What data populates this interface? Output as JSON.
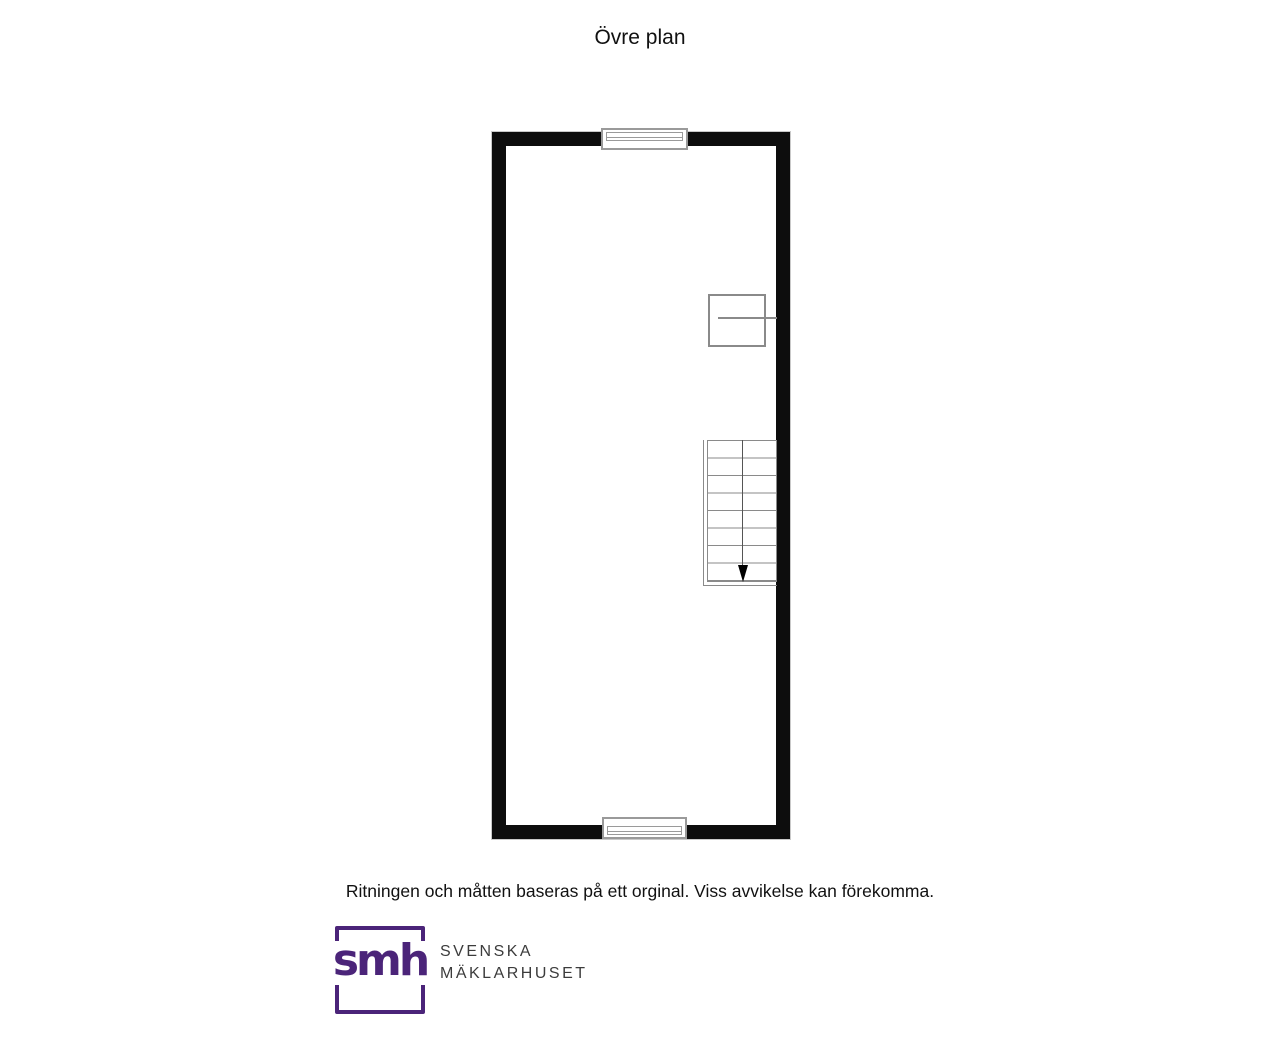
{
  "page": {
    "title": "Övre plan",
    "disclaimer": "Ritningen och måtten baseras på ett orginal. Viss avvikelse kan förekomma."
  },
  "floor_plan": {
    "label": "Övre plan (upper floor) floor plan",
    "features": {
      "top_window": "window",
      "bottom_window": "window",
      "closet": "closet-fixture",
      "stairs": "staircase",
      "stair_steps": 8,
      "stair_direction": "down"
    }
  },
  "logo": {
    "monogram": "smh",
    "name_line1": "SVENSKA",
    "name_line2": "MÄKLARHUSET"
  },
  "colors": {
    "brand_purple": "#4B2479",
    "wall_black": "#0D0D0D",
    "plan_line_gray": "#8A8A8A",
    "logo_text_gray": "#3C3C3C"
  }
}
